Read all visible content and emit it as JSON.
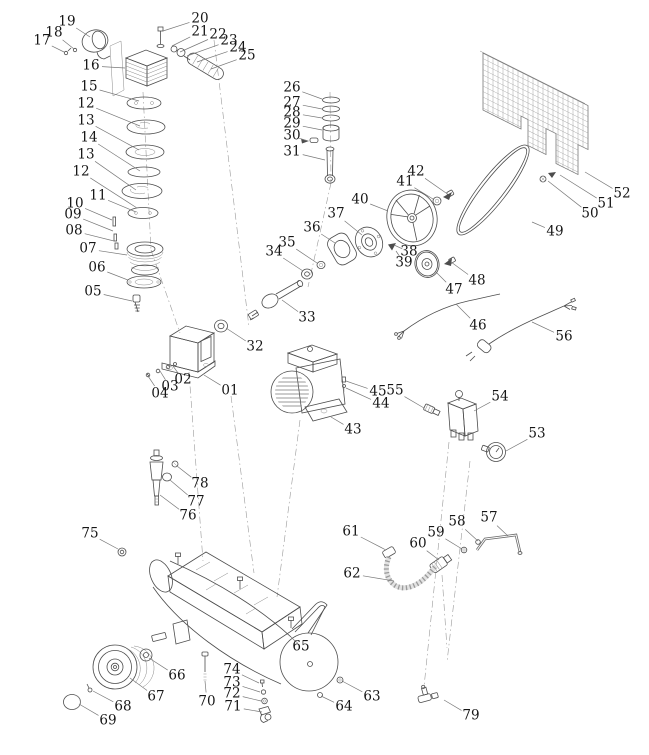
{
  "diagram": {
    "subject": "air compressor exploded parts diagram",
    "background_color": "#ffffff",
    "line_color": "#4d4d4d",
    "label_color": "#161616",
    "label_font_size": 13.5,
    "part_count": 79
  },
  "parts": [
    {
      "num": "01",
      "lx": 230,
      "ly": 391,
      "tx": 204,
      "ty": 375
    },
    {
      "num": "02",
      "lx": 183,
      "ly": 380,
      "tx": 173,
      "ty": 366
    },
    {
      "num": "03",
      "lx": 170,
      "ly": 387,
      "tx": 160,
      "ty": 371
    },
    {
      "num": "04",
      "lx": 160,
      "ly": 394,
      "tx": 148,
      "ty": 376
    },
    {
      "num": "05",
      "lx": 93,
      "ly": 292,
      "tx": 132,
      "ty": 301
    },
    {
      "num": "06",
      "lx": 97,
      "ly": 268,
      "tx": 128,
      "ty": 280
    },
    {
      "num": "07",
      "lx": 88,
      "ly": 249,
      "tx": 127,
      "ty": 255
    },
    {
      "num": "08",
      "lx": 74,
      "ly": 231,
      "tx": 114,
      "ty": 241
    },
    {
      "num": "09",
      "lx": 73,
      "ly": 215,
      "tx": 113,
      "ty": 231
    },
    {
      "num": "10",
      "lx": 75,
      "ly": 204,
      "tx": 112,
      "ty": 220
    },
    {
      "num": "11",
      "lx": 98,
      "ly": 196,
      "tx": 136,
      "ty": 212
    },
    {
      "num": "12",
      "lx": 86,
      "ly": 104,
      "tx": 140,
      "ty": 126
    },
    {
      "num": "13",
      "lx": 86,
      "ly": 121,
      "tx": 139,
      "ty": 150
    },
    {
      "num": "14",
      "lx": 89,
      "ly": 138,
      "tx": 140,
      "ty": 171
    },
    {
      "num": "13",
      "lx": 86,
      "ly": 155,
      "tx": 136,
      "ty": 190
    },
    {
      "num": "12",
      "lx": 81,
      "ly": 172,
      "tx": 137,
      "ty": 208
    },
    {
      "num": "15",
      "lx": 89,
      "ly": 87,
      "tx": 139,
      "ty": 101
    },
    {
      "num": "16",
      "lx": 91,
      "ly": 66,
      "tx": 125,
      "ty": 68
    },
    {
      "num": "17",
      "lx": 42,
      "ly": 41,
      "tx": 64,
      "ty": 52
    },
    {
      "num": "18",
      "lx": 54,
      "ly": 33,
      "tx": 74,
      "ty": 49
    },
    {
      "num": "19",
      "lx": 67,
      "ly": 22,
      "tx": 90,
      "ty": 37
    },
    {
      "num": "20",
      "lx": 200,
      "ly": 19,
      "tx": 163,
      "ty": 31
    },
    {
      "num": "21",
      "lx": 200,
      "ly": 32,
      "tx": 172,
      "ty": 46
    },
    {
      "num": "22",
      "lx": 218,
      "ly": 35,
      "tx": 180,
      "ty": 52
    },
    {
      "num": "23",
      "lx": 229,
      "ly": 41,
      "tx": 187,
      "ty": 56
    },
    {
      "num": "24",
      "lx": 238,
      "ly": 48,
      "tx": 197,
      "ty": 62
    },
    {
      "num": "25",
      "lx": 247,
      "ly": 56,
      "tx": 211,
      "ty": 69
    },
    {
      "num": "26",
      "lx": 292,
      "ly": 88,
      "tx": 322,
      "ty": 99
    },
    {
      "num": "27",
      "lx": 292,
      "ly": 103,
      "tx": 322,
      "ty": 109
    },
    {
      "num": "28",
      "lx": 292,
      "ly": 113,
      "tx": 322,
      "ty": 118
    },
    {
      "num": "29",
      "lx": 292,
      "ly": 124,
      "tx": 322,
      "ty": 130
    },
    {
      "num": "30",
      "lx": 292,
      "ly": 136,
      "tx": 308,
      "ty": 141
    },
    {
      "num": "31",
      "lx": 292,
      "ly": 152,
      "tx": 325,
      "ty": 160
    },
    {
      "num": "32",
      "lx": 255,
      "ly": 347,
      "tx": 226,
      "ty": 328
    },
    {
      "num": "33",
      "lx": 307,
      "ly": 318,
      "tx": 282,
      "ty": 300
    },
    {
      "num": "34",
      "lx": 274,
      "ly": 252,
      "tx": 303,
      "ty": 271
    },
    {
      "num": "35",
      "lx": 287,
      "ly": 243,
      "tx": 317,
      "ty": 263
    },
    {
      "num": "36",
      "lx": 312,
      "ly": 228,
      "tx": 335,
      "ty": 243
    },
    {
      "num": "37",
      "lx": 336,
      "ly": 214,
      "tx": 362,
      "ty": 235
    },
    {
      "num": "38",
      "lx": 409,
      "ly": 252,
      "tx": 394,
      "ty": 245
    },
    {
      "num": "39",
      "lx": 404,
      "ly": 263,
      "tx": 396,
      "ty": 251
    },
    {
      "num": "40",
      "lx": 360,
      "ly": 200,
      "tx": 388,
      "ty": 211
    },
    {
      "num": "41",
      "lx": 405,
      "ly": 182,
      "tx": 433,
      "ty": 199
    },
    {
      "num": "42",
      "lx": 416,
      "ly": 172,
      "tx": 446,
      "ty": 193
    },
    {
      "num": "43",
      "lx": 353,
      "ly": 430,
      "tx": 331,
      "ty": 417
    },
    {
      "num": "44",
      "lx": 381,
      "ly": 404,
      "tx": 346,
      "ty": 388
    },
    {
      "num": "45",
      "lx": 378,
      "ly": 392,
      "tx": 346,
      "ty": 381
    },
    {
      "num": "46",
      "lx": 478,
      "ly": 326,
      "tx": 456,
      "ty": 304
    },
    {
      "num": "47",
      "lx": 454,
      "ly": 290,
      "tx": 436,
      "ty": 272
    },
    {
      "num": "48",
      "lx": 477,
      "ly": 281,
      "tx": 451,
      "ty": 262
    },
    {
      "num": "49",
      "lx": 555,
      "ly": 232,
      "tx": 532,
      "ty": 222
    },
    {
      "num": "50",
      "lx": 590,
      "ly": 214,
      "tx": 548,
      "ty": 181
    },
    {
      "num": "51",
      "lx": 606,
      "ly": 204,
      "tx": 560,
      "ty": 175
    },
    {
      "num": "52",
      "lx": 622,
      "ly": 194,
      "tx": 585,
      "ty": 172
    },
    {
      "num": "53",
      "lx": 537,
      "ly": 434,
      "tx": 506,
      "ty": 451
    },
    {
      "num": "54",
      "lx": 500,
      "ly": 397,
      "tx": 474,
      "ty": 411
    },
    {
      "num": "55",
      "lx": 395,
      "ly": 391,
      "tx": 424,
      "ty": 408
    },
    {
      "num": "56",
      "lx": 564,
      "ly": 337,
      "tx": 532,
      "ty": 322
    },
    {
      "num": "57",
      "lx": 489,
      "ly": 518,
      "tx": 508,
      "ty": 536
    },
    {
      "num": "58",
      "lx": 457,
      "ly": 522,
      "tx": 478,
      "ty": 541
    },
    {
      "num": "59",
      "lx": 436,
      "ly": 533,
      "tx": 462,
      "ty": 549
    },
    {
      "num": "60",
      "lx": 418,
      "ly": 544,
      "tx": 439,
      "ty": 560
    },
    {
      "num": "61",
      "lx": 351,
      "ly": 532,
      "tx": 386,
      "ty": 550
    },
    {
      "num": "62",
      "lx": 352,
      "ly": 574,
      "tx": 394,
      "ty": 581
    },
    {
      "num": "63",
      "lx": 372,
      "ly": 697,
      "tx": 342,
      "ty": 681
    },
    {
      "num": "64",
      "lx": 344,
      "ly": 707,
      "tx": 321,
      "ty": 696
    },
    {
      "num": "65",
      "lx": 301,
      "ly": 647,
      "tx": 291,
      "ty": 637
    },
    {
      "num": "66",
      "lx": 177,
      "ly": 676,
      "tx": 149,
      "ty": 658
    },
    {
      "num": "67",
      "lx": 156,
      "ly": 697,
      "tx": 130,
      "ty": 678
    },
    {
      "num": "68",
      "lx": 123,
      "ly": 707,
      "tx": 93,
      "ty": 691
    },
    {
      "num": "69",
      "lx": 108,
      "ly": 721,
      "tx": 79,
      "ty": 704
    },
    {
      "num": "70",
      "lx": 207,
      "ly": 702,
      "tx": 205,
      "ty": 681
    },
    {
      "num": "71",
      "lx": 233,
      "ly": 707,
      "tx": 262,
      "ty": 712
    },
    {
      "num": "72",
      "lx": 232,
      "ly": 694,
      "tx": 261,
      "ty": 701
    },
    {
      "num": "73",
      "lx": 232,
      "ly": 683,
      "tx": 260,
      "ty": 692
    },
    {
      "num": "74",
      "lx": 232,
      "ly": 670,
      "tx": 259,
      "ty": 683
    },
    {
      "num": "75",
      "lx": 90,
      "ly": 534,
      "tx": 118,
      "ty": 549
    },
    {
      "num": "76",
      "lx": 188,
      "ly": 516,
      "tx": 160,
      "ty": 495
    },
    {
      "num": "77",
      "lx": 196,
      "ly": 502,
      "tx": 170,
      "ty": 480
    },
    {
      "num": "78",
      "lx": 200,
      "ly": 484,
      "tx": 177,
      "ty": 466
    },
    {
      "num": "79",
      "lx": 471,
      "ly": 716,
      "tx": 444,
      "ty": 700
    }
  ]
}
